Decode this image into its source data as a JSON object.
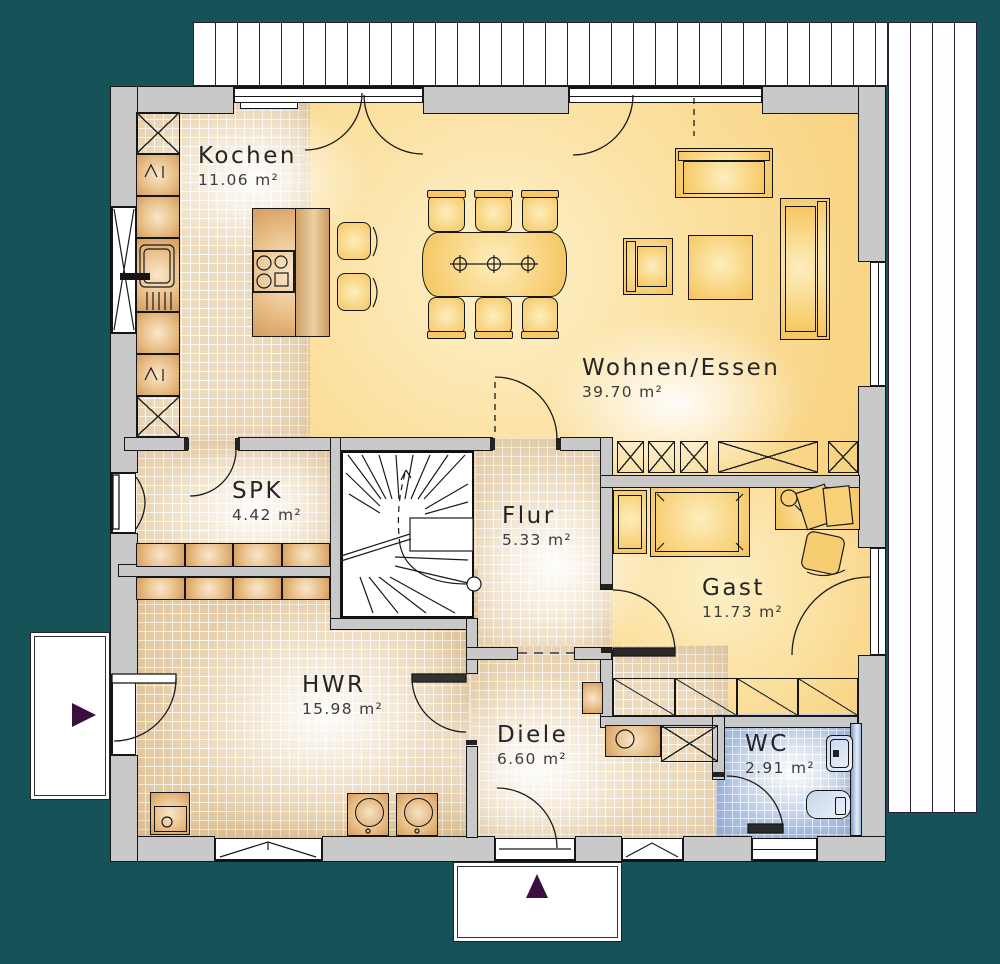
{
  "rooms": {
    "kochen": {
      "name": "Kochen",
      "area": "11.06 m²"
    },
    "wohnen": {
      "name": "Wohnen/Essen",
      "area": "39.70 m²"
    },
    "spk": {
      "name": "SPK",
      "area": "4.42 m²"
    },
    "flur": {
      "name": "Flur",
      "area": "5.33 m²"
    },
    "gast": {
      "name": "Gast",
      "area": "11.73 m²"
    },
    "hwr": {
      "name": "HWR",
      "area": "15.98 m²"
    },
    "diele": {
      "name": "Diele",
      "area": "6.60 m²"
    },
    "wc": {
      "name": "WC",
      "area": "2.91 m²"
    }
  },
  "markers": {
    "side_entrance_direction": "right",
    "main_entrance_direction": "up"
  },
  "colors": {
    "background": "#155359",
    "walls": "#c9c9c9",
    "living_area": "#f8d17c",
    "tile_floor": "#ecdabc",
    "wc_tile": "#b3c8e8",
    "furniture": "#f3c35f",
    "cabinets": "#dca76c",
    "entrance_marker": "#3b1040",
    "deck_lines": "#301d36"
  }
}
